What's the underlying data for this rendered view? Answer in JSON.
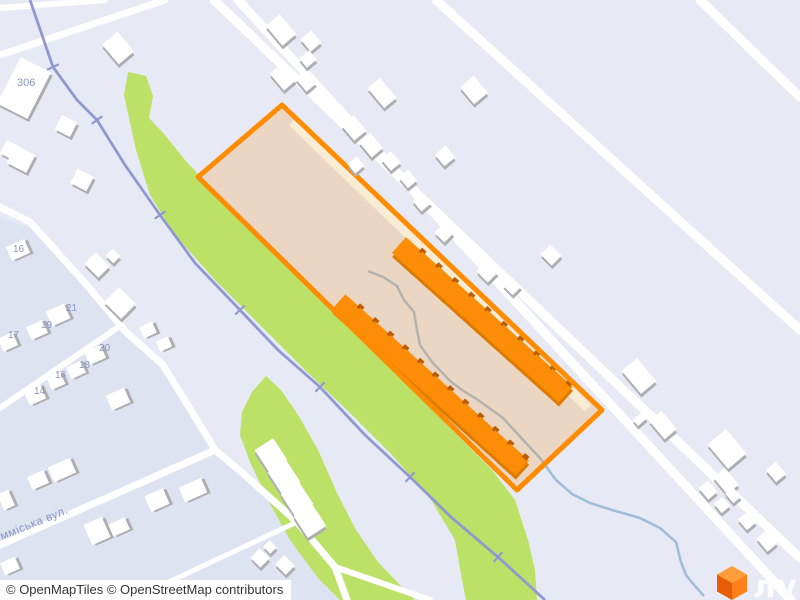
{
  "map": {
    "colors": {
      "bg": "#e7eaf5",
      "residential": "#dde3f0",
      "road": "#ffffff",
      "green": "#bbe167",
      "railway": "#8f99cf",
      "site_fill": "#fc9215",
      "site_fill_opacity": "0.22",
      "site_border": "#ff8c00",
      "inner_road": "#f8ecd4",
      "orange_building": "#fd8d07",
      "orange_building_shadow": "#de7a00",
      "orange_building_nub": "#b95e00",
      "white_building": "#ffffff",
      "building_shadow": "#aeaeb2",
      "stream": "#9fbcd9",
      "house_number_color": "#8a94c0",
      "street_label_color": "#8795c2",
      "attribution_text_color": "#333333",
      "logo_cube_top": "#ff9d3d",
      "logo_cube_left": "#e85c08",
      "logo_cube_right": "#ff7f19",
      "logo_text_color": "#fdfdfe"
    },
    "site": {
      "points": "282,105 198,177 517,490 602,410"
    },
    "inner_road_line": {
      "x1": 292,
      "y1": 122,
      "x2": 588,
      "y2": 408
    },
    "residential_points": "0,218 38,230 90,285 127,333 163,365 203,430 215,450 247,477 297,522 335,567 350,585 365,600 0,600",
    "green_strips": [
      "128,72 146,76 153,96 149,118 165,135 185,160 215,192 262,242 312,292 362,341 407,385 452,430 492,470 515,500 528,540 535,570 537,600 466,600 462,580 455,540 430,498 392,455 350,413 305,370 260,325 215,280 175,235 150,195 136,150 124,95",
      "266,376 281,390 300,418 318,450 338,495 356,530 378,562 400,585 415,600 340,600 318,578 290,540 268,500 250,462 240,435 242,412 252,392"
    ],
    "roads": [
      {
        "w": 9,
        "pts": [
          [
            214,
            0
          ],
          [
            306,
            88
          ],
          [
            800,
            558
          ]
        ]
      },
      {
        "w": 9,
        "pts": [
          [
            238,
            0
          ],
          [
            588,
            380
          ],
          [
            791,
            600
          ]
        ]
      },
      {
        "w": 9,
        "pts": [
          [
            436,
            0
          ],
          [
            800,
            330
          ]
        ]
      },
      {
        "w": 9,
        "pts": [
          [
            700,
            0
          ],
          [
            800,
            97
          ]
        ]
      },
      {
        "w": 6,
        "pts": [
          [
            0,
            8
          ],
          [
            105,
            0
          ]
        ]
      },
      {
        "w": 7,
        "pts": [
          [
            0,
            55
          ],
          [
            165,
            0
          ]
        ]
      },
      {
        "w": 7,
        "pts": [
          [
            0,
            207
          ],
          [
            30,
            222
          ],
          [
            85,
            283
          ],
          [
            127,
            333
          ],
          [
            163,
            365
          ],
          [
            203,
            430
          ],
          [
            215,
            450
          ]
        ]
      },
      {
        "w": 7,
        "pts": [
          [
            0,
            545
          ],
          [
            215,
            450
          ]
        ]
      },
      {
        "w": 7,
        "pts": [
          [
            215,
            450
          ],
          [
            247,
            477
          ],
          [
            297,
            522
          ],
          [
            335,
            567
          ],
          [
            347,
            600
          ]
        ]
      },
      {
        "w": 6,
        "pts": [
          [
            117,
            328
          ],
          [
            0,
            408
          ]
        ]
      },
      {
        "w": 6,
        "pts": [
          [
            335,
            567
          ],
          [
            430,
            600
          ]
        ]
      },
      {
        "w": 5,
        "pts": [
          [
            130,
            600
          ],
          [
            297,
            522
          ]
        ]
      }
    ],
    "railway": {
      "pts": [
        [
          30,
          0
        ],
        [
          53,
          67
        ],
        [
          77,
          100
        ],
        [
          97,
          120
        ],
        [
          125,
          165
        ],
        [
          160,
          215
        ],
        [
          195,
          263
        ],
        [
          240,
          310
        ],
        [
          278,
          350
        ],
        [
          320,
          387
        ],
        [
          365,
          435
        ],
        [
          410,
          477
        ],
        [
          452,
          518
        ],
        [
          498,
          557
        ],
        [
          545,
          600
        ]
      ],
      "tick_len": 13
    },
    "stream_path": "M368,271 L383,277 L397,286 L404,300 L414,312 L417,330 L420,345 L432,362 L450,381 L462,390 L478,400 L503,418 L525,442 L540,458 L556,480 L572,494 L590,503 L612,510 L640,518 L660,528 L676,542 L681,562 L686,575 L695,586 L704,596",
    "orange_rows": [
      {
        "x": 409,
        "y": 254,
        "count": 10,
        "dx": 16.3,
        "dy": 14.6,
        "w": 27,
        "h": 21,
        "r": 42
      },
      {
        "x": 348,
        "y": 310,
        "count": 12,
        "dx": 15.0,
        "dy": 13.6,
        "w": 25,
        "h": 20,
        "r": 42
      }
    ],
    "white_buildings": [
      [
        24,
        88,
        34,
        52,
        27
      ],
      [
        66,
        126,
        17,
        16,
        27
      ],
      [
        10,
        150,
        15,
        15,
        27
      ],
      [
        21,
        159,
        22,
        20,
        27
      ],
      [
        82,
        180,
        18,
        16,
        27
      ],
      [
        118,
        48,
        26,
        20,
        50
      ],
      [
        281,
        30,
        26,
        18,
        50
      ],
      [
        311,
        41,
        16,
        14,
        50
      ],
      [
        308,
        59,
        12,
        13,
        50
      ],
      [
        283,
        77,
        22,
        16,
        50
      ],
      [
        306,
        81,
        17,
        13,
        50
      ],
      [
        382,
        93,
        26,
        16,
        50
      ],
      [
        474,
        90,
        22,
        18,
        50
      ],
      [
        354,
        128,
        20,
        16,
        50
      ],
      [
        371,
        145,
        20,
        15,
        50
      ],
      [
        391,
        161,
        15,
        13,
        50
      ],
      [
        356,
        165,
        12,
        12,
        50
      ],
      [
        408,
        179,
        14,
        12,
        50
      ],
      [
        445,
        156,
        15,
        14,
        50
      ],
      [
        422,
        202,
        14,
        13,
        50
      ],
      [
        444,
        233,
        14,
        13,
        45
      ],
      [
        487,
        272,
        16,
        14,
        45
      ],
      [
        512,
        286,
        14,
        12,
        45
      ],
      [
        551,
        255,
        16,
        14,
        45
      ],
      [
        639,
        376,
        30,
        20,
        50
      ],
      [
        640,
        419,
        8,
        12,
        50
      ],
      [
        663,
        425,
        24,
        16,
        50
      ],
      [
        727,
        449,
        32,
        24,
        50
      ],
      [
        726,
        481,
        22,
        15,
        50
      ],
      [
        776,
        472,
        16,
        13,
        50
      ],
      [
        733,
        495,
        13,
        10,
        50
      ],
      [
        708,
        490,
        15,
        12,
        50
      ],
      [
        722,
        505,
        12,
        11,
        50
      ],
      [
        747,
        521,
        14,
        12,
        50
      ],
      [
        767,
        541,
        17,
        13,
        50
      ],
      [
        18,
        250,
        20,
        15,
        -24
      ],
      [
        97,
        265,
        20,
        16,
        45
      ],
      [
        113,
        256,
        11,
        10,
        45
      ],
      [
        120,
        303,
        24,
        21,
        45
      ],
      [
        148,
        330,
        14,
        12,
        -24
      ],
      [
        164,
        344,
        13,
        11,
        -24
      ],
      [
        58,
        315,
        20,
        16,
        -24
      ],
      [
        37,
        330,
        18,
        14,
        -24
      ],
      [
        8,
        342,
        16,
        14,
        -24
      ],
      [
        95,
        355,
        18,
        14,
        -24
      ],
      [
        76,
        370,
        16,
        13,
        -24
      ],
      [
        56,
        381,
        15,
        13,
        -24
      ],
      [
        35,
        395,
        18,
        15,
        -24
      ],
      [
        118,
        399,
        20,
        16,
        -24
      ],
      [
        38,
        480,
        18,
        14,
        -24
      ],
      [
        62,
        470,
        24,
        16,
        -24
      ],
      [
        6,
        500,
        12,
        17,
        -24
      ],
      [
        97,
        531,
        20,
        22,
        -24
      ],
      [
        119,
        527,
        18,
        13,
        -24
      ],
      [
        157,
        500,
        20,
        17,
        -24
      ],
      [
        193,
        490,
        24,
        16,
        -24
      ],
      [
        10,
        566,
        16,
        13,
        -24
      ],
      [
        260,
        558,
        14,
        13,
        45
      ],
      [
        285,
        565,
        15,
        13,
        45
      ],
      [
        270,
        547,
        10,
        9,
        45
      ],
      [
        271,
        455,
        26,
        22,
        57
      ],
      [
        284,
        477,
        26,
        22,
        57
      ],
      [
        297,
        499,
        26,
        22,
        57
      ],
      [
        310,
        521,
        26,
        22,
        57
      ]
    ],
    "house_numbers": [
      {
        "text": "306",
        "x": 17,
        "y": 86
      },
      {
        "text": "16",
        "x": 13,
        "y": 252
      },
      {
        "text": "21",
        "x": 66,
        "y": 311
      },
      {
        "text": "19",
        "x": 41,
        "y": 328
      },
      {
        "text": "17",
        "x": 8,
        "y": 338
      },
      {
        "text": "20",
        "x": 99,
        "y": 351
      },
      {
        "text": "18",
        "x": 79,
        "y": 368
      },
      {
        "text": "16",
        "x": 55,
        "y": 378
      },
      {
        "text": "14",
        "x": 34,
        "y": 394
      }
    ],
    "street_label": {
      "text": "мміська вул.",
      "x": 2,
      "y": 540,
      "angle": -22
    }
  },
  "attribution": {
    "text": "© OpenMapTiles © OpenStreetMap contributors"
  },
  "logo": {
    "text": "лун"
  }
}
